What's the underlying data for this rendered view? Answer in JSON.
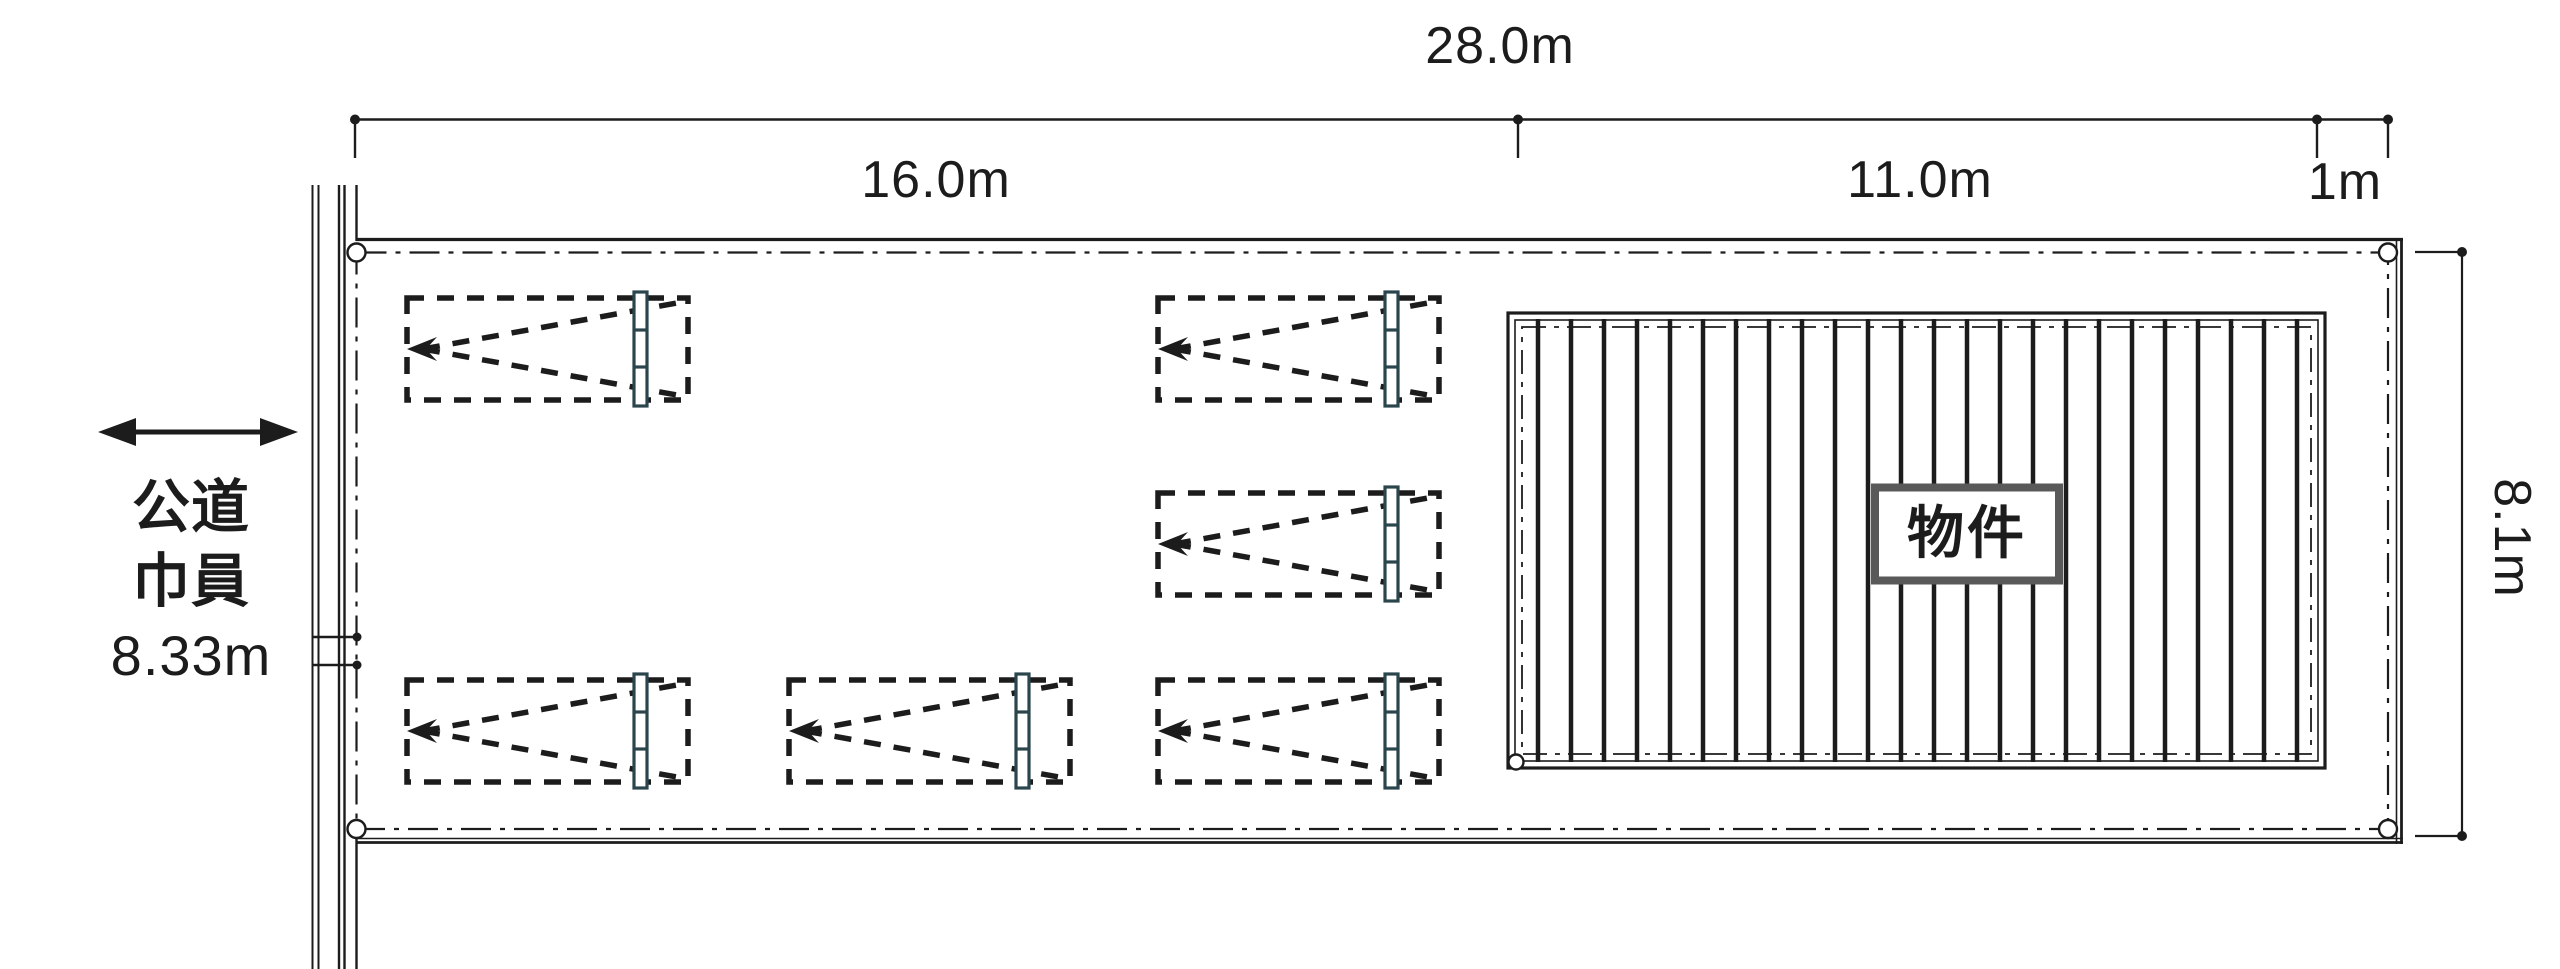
{
  "dimensions": {
    "total_width": "28.0m",
    "left_section": "16.0m",
    "building_section": "11.0m",
    "right_margin": "1m",
    "depth": "8.1m"
  },
  "road": {
    "label_line1": "公道",
    "label_line2": "巾員",
    "label_line3": "8.33m"
  },
  "building": {
    "label": "物件"
  },
  "parking": {
    "space_count": 6
  },
  "colors": {
    "line": "#1c1c1c",
    "car_marker": "#2b454c",
    "building_label_border": "#595959",
    "background": "#ffffff"
  }
}
